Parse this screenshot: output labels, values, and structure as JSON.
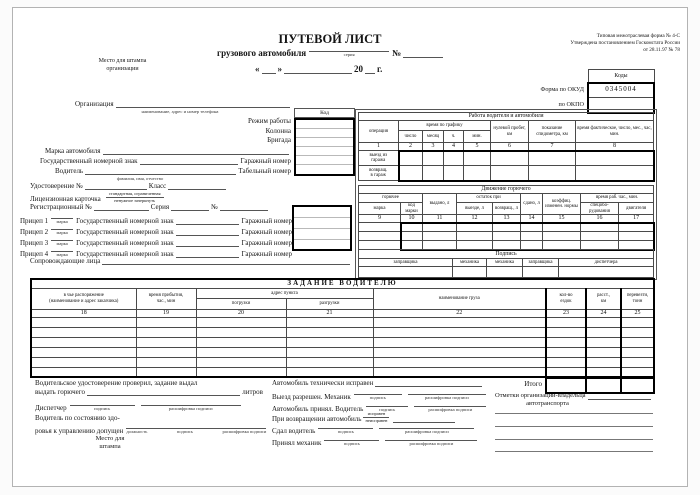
{
  "meta": {
    "note1": "Типовая межотраслевая форма № 4-С",
    "note2": "Утверждена постановлением Госкомстата России",
    "note3": "от 28.11.97 № 78"
  },
  "stamp": {
    "line1": "Место для штампа",
    "line2": "организации"
  },
  "title": {
    "main": "ПУТЕВОЙ ЛИСТ",
    "sub": "грузового автомобиля",
    "series_hint": "серия",
    "no": "№",
    "quote_open": "«",
    "quote_close": "»",
    "year": "20",
    "year_suffix": "г."
  },
  "codes": {
    "header": "Коды",
    "okud_label": "Форма по ОКУД",
    "okud_value": "0345004",
    "okpo_label": "по ОКПО"
  },
  "org": {
    "label": "Организация",
    "hint": "наименование, адрес и номер телефона",
    "kod_header": "Код",
    "mode_label": "Режим работы",
    "column_label": "Колонна",
    "brigade_label": "Бригада",
    "brand_label": "Марка автомобиля",
    "plate_label": "Государственный номерной знак",
    "garage_label": "Гаражный номер",
    "driver_label": "Водитель",
    "driver_hint": "фамилия, имя, отчество",
    "tab_label": "Табельный номер",
    "cert_label": "Удостоверение №",
    "class_label": "Класс",
    "lic_label": "Лицензионная карточка",
    "lic_hint1": "стандартная, ограниченная",
    "lic_hint2": "ненужное зачеркнуть",
    "reg_label": "Регистрационный №",
    "series_label": "Серия",
    "no_label": "№",
    "trailer_hint": "марка",
    "trailers": [
      {
        "label": "Прицеп 1"
      },
      {
        "label": "Прицеп 2"
      },
      {
        "label": "Прицеп 3"
      },
      {
        "label": "Прицеп 4"
      }
    ],
    "escort_label": "Сопровождающие лица"
  },
  "work": {
    "title": "Работа водителя и автомобиля",
    "operation": "операция",
    "sched": "время по графику",
    "day": "число",
    "month": "месяц",
    "hour": "ч.",
    "minute": "мин.",
    "zero_run": "нулевой пробег, км",
    "odometer": "показание спидометра, км",
    "actual": "время фактическое, число, мес., час, мин.",
    "nums": [
      "1",
      "2",
      "3",
      "4",
      "5",
      "6",
      "7",
      "8"
    ],
    "r1a": "выезд из",
    "r1b": "гаража",
    "r2a": "возвращ.",
    "r2b": "в гараж"
  },
  "fuel": {
    "title": "Движение горючего",
    "fuel": "горючее",
    "brand": "марка",
    "brand_code": "код марки",
    "issued": "выдано, л",
    "remain": "остаток при",
    "depart": "выезде, л",
    "ret": "возвращ., л",
    "handed": "сдано, л",
    "coeff": "коэффиц. изменен. нормы",
    "worktime": "время раб. час., мин.",
    "special": "спецобо- рудования",
    "engine": "двигателя",
    "nums": [
      "9",
      "10",
      "11",
      "12",
      "13",
      "14",
      "15",
      "16",
      "17"
    ],
    "sign_title": "Подпись",
    "signs": [
      "заправщика",
      "механика",
      "механика",
      "заправщика",
      "диспетчера"
    ]
  },
  "task": {
    "title": "ЗАДАНИЕ ВОДИТЕЛЮ",
    "customer1": "в чье распоряжение",
    "customer2": "(наименование и адрес заказчика)",
    "arrive1": "время прибытия,",
    "arrive2": "час., мин",
    "address": "адрес пункта",
    "loading": "погрузки",
    "unloading": "разгрузки",
    "cargo": "наименование груза",
    "trips1": "кол-во",
    "trips2": "ездок",
    "dist1": "расст.,",
    "dist2": "км",
    "tons1": "перевезти,",
    "tons2": "тонн",
    "nums": [
      "18",
      "19",
      "20",
      "21",
      "22",
      "23",
      "24",
      "25"
    ],
    "total": "Итого"
  },
  "hints": {
    "sign": "подпись",
    "decode": "расшифровка подписи",
    "position": "должность"
  },
  "bottom": {
    "checked": "Водительское удостоверение проверил, задание выдал",
    "fuel_issue": "выдать горючего",
    "liters": "литров",
    "dispatcher": "Диспетчер",
    "health1": "Водитель по состоянию здо-",
    "health2": "ровья к управлению допущен",
    "stamp1": "Место для",
    "stamp2": "штампа",
    "tech_ok": "Автомобиль технически исправен",
    "depart": "Выезд разрешен. Механик",
    "accepted": "Автомобиль принял. Водитель",
    "on_return": "При возвращении автомобиль",
    "ok_hint": "исправен",
    "fail_hint": "неисправен",
    "handed": "Сдал водитель",
    "received": "Принял механик",
    "notes1": "Отметки организации-владельца",
    "notes2": "автотранспорта"
  }
}
